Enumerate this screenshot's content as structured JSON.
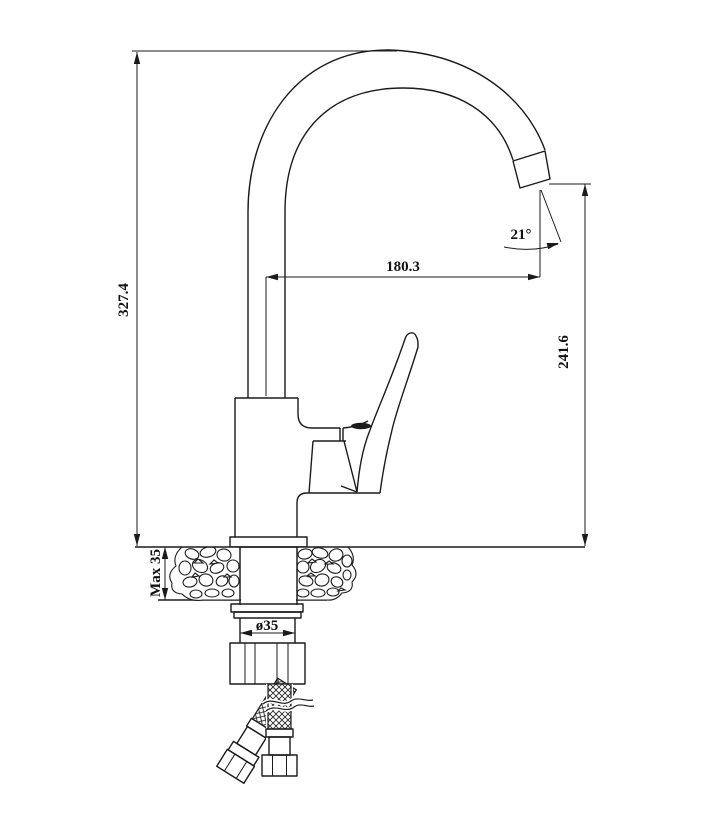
{
  "meta": {
    "title": "Kitchen faucet technical drawing",
    "view": "side elevation with mounting hoses"
  },
  "dimensions": {
    "overall_height": "327.4",
    "spout_outlet_height": "241.6",
    "spout_reach": "180.3",
    "outlet_angle": "21°",
    "max_mounting_thickness": "Max 35",
    "mounting_hole_diameter": "ø35"
  },
  "colors": {
    "line": "#1b1b1b",
    "background": "#ffffff"
  }
}
